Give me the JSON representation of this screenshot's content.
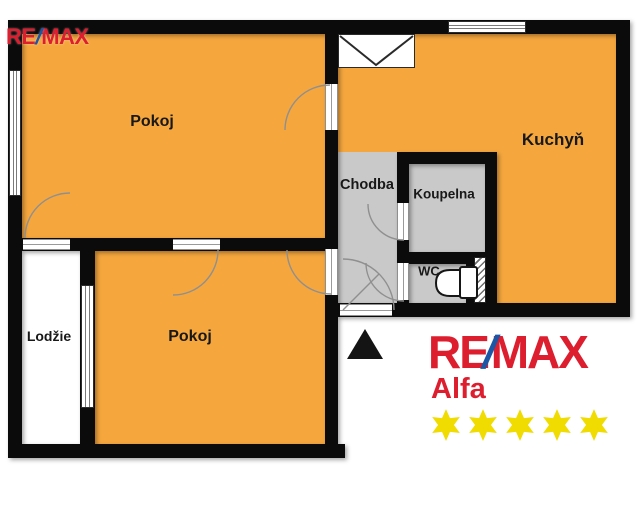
{
  "plan": {
    "rooms": {
      "room1": {
        "label": "Pokoj"
      },
      "kitchen": {
        "label": "Kuchyň"
      },
      "hallway": {
        "label": "Chodba"
      },
      "bathroom": {
        "label": "Koupelna"
      },
      "wc": {
        "label": "WC"
      },
      "room2": {
        "label": "Pokoj"
      },
      "loggia": {
        "label": "Lodžie"
      }
    },
    "colors": {
      "room_fill": "#F5A73E",
      "service_fill": "#C9C9C9",
      "wall": "#0B0B0B"
    }
  },
  "branding": {
    "watermark": {
      "pre": "RE",
      "slash": "/",
      "post": "MAX"
    },
    "agency": {
      "pre": "RE",
      "slash": "/",
      "post": "MAX",
      "sub": "Alfa",
      "stars": 5
    },
    "colors": {
      "red": "#DC1E2E",
      "blue": "#1B57A5",
      "star": "#F0DC00"
    }
  }
}
